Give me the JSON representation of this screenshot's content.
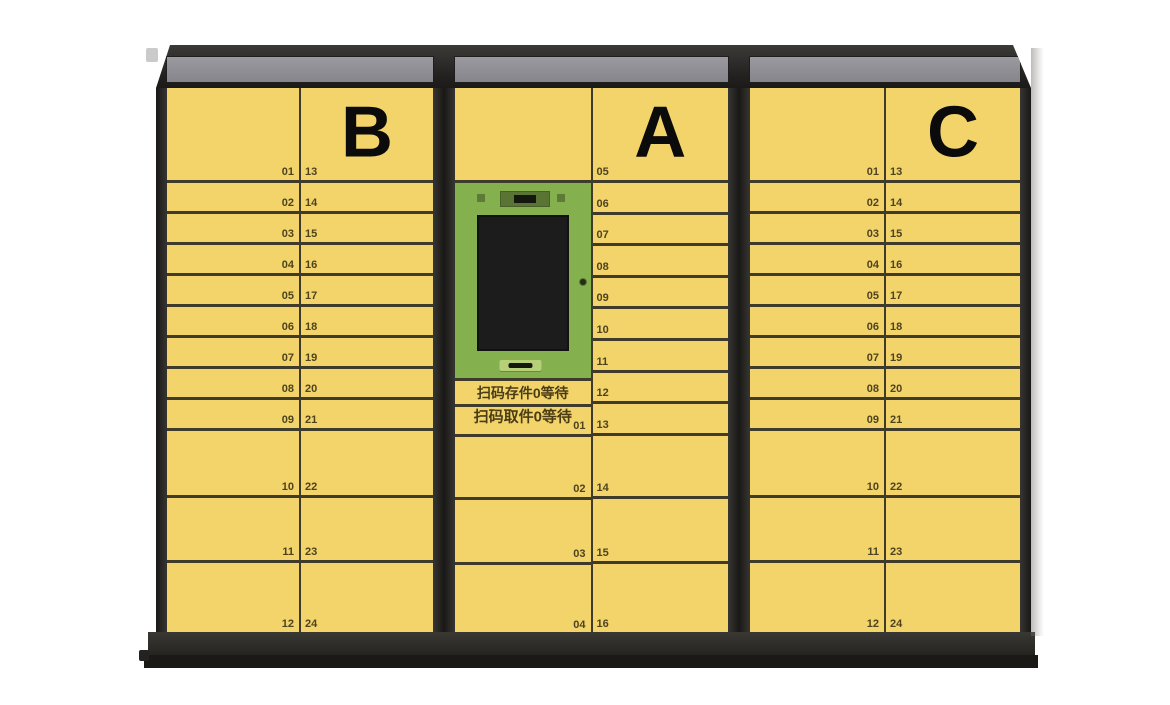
{
  "colors": {
    "door_yellow": "#F2D46A",
    "door_line": "#3E3B2B",
    "frame_dark": "#343330",
    "sign_gray": "#85858B",
    "sign_gray_hi": "#9A9AA0",
    "kiosk_green": "#85B04E",
    "kiosk_dark_green": "#5A7433",
    "kiosk_light_green": "#B6CF79",
    "screen_black": "#1C1C1C",
    "number_text": "#4E431F",
    "cjk_text": "#4A3D16",
    "letter_text": "#0B0B0B",
    "base_dark": "#262420",
    "base_shadow": "#1B1915"
  },
  "cabinets": [
    {
      "id": "b",
      "label": "B",
      "columns": [
        {
          "num_align": "right",
          "cells": [
            {
              "size": "t1",
              "num": "01"
            },
            {
              "size": "s",
              "num": "02"
            },
            {
              "size": "s",
              "num": "03"
            },
            {
              "size": "s",
              "num": "04"
            },
            {
              "size": "s",
              "num": "05"
            },
            {
              "size": "s",
              "num": "06"
            },
            {
              "size": "s",
              "num": "07"
            },
            {
              "size": "s",
              "num": "08"
            },
            {
              "size": "s",
              "num": "09"
            },
            {
              "size": "m1",
              "num": "10"
            },
            {
              "size": "m2",
              "num": "11"
            },
            {
              "size": "m3",
              "num": "12"
            }
          ]
        },
        {
          "num_align": "left",
          "cells": [
            {
              "size": "t1",
              "num": "13",
              "letter": true
            },
            {
              "size": "s",
              "num": "14"
            },
            {
              "size": "s",
              "num": "15"
            },
            {
              "size": "s",
              "num": "16"
            },
            {
              "size": "s",
              "num": "17"
            },
            {
              "size": "s",
              "num": "18"
            },
            {
              "size": "s",
              "num": "19"
            },
            {
              "size": "s",
              "num": "20"
            },
            {
              "size": "s",
              "num": "21"
            },
            {
              "size": "m1",
              "num": "22"
            },
            {
              "size": "m2",
              "num": "23"
            },
            {
              "size": "m3",
              "num": "24"
            }
          ]
        }
      ]
    },
    {
      "id": "a",
      "label": "A",
      "columns": [
        {
          "num_align": "right",
          "cells": [
            {
              "size": "t1"
            },
            {
              "size": "kiosk"
            },
            {
              "size": "tx1",
              "text": "扫码存件0等待"
            },
            {
              "size": "tx2",
              "text": "扫码取件0等待",
              "num": "01"
            },
            {
              "size": "a2",
              "num": "02"
            },
            {
              "size": "a3",
              "num": "03"
            },
            {
              "size": "a4",
              "num": "04"
            }
          ]
        },
        {
          "num_align": "left",
          "cells": [
            {
              "size": "t1",
              "num": "05",
              "letter": true
            },
            {
              "size": "sa",
              "num": "06"
            },
            {
              "size": "sa",
              "num": "07"
            },
            {
              "size": "sa",
              "num": "08"
            },
            {
              "size": "sa",
              "num": "09"
            },
            {
              "size": "sa",
              "num": "10"
            },
            {
              "size": "sa",
              "num": "11"
            },
            {
              "size": "sa",
              "num": "12"
            },
            {
              "size": "sa",
              "num": "13"
            },
            {
              "size": "a2",
              "num": "14"
            },
            {
              "size": "a3",
              "num": "15"
            },
            {
              "size": "a4",
              "num": "16"
            }
          ]
        }
      ]
    },
    {
      "id": "c",
      "label": "C",
      "columns": [
        {
          "num_align": "right",
          "cells": [
            {
              "size": "t1",
              "num": "01"
            },
            {
              "size": "s",
              "num": "02"
            },
            {
              "size": "s",
              "num": "03"
            },
            {
              "size": "s",
              "num": "04"
            },
            {
              "size": "s",
              "num": "05"
            },
            {
              "size": "s",
              "num": "06"
            },
            {
              "size": "s",
              "num": "07"
            },
            {
              "size": "s",
              "num": "08"
            },
            {
              "size": "s",
              "num": "09"
            },
            {
              "size": "m1",
              "num": "10"
            },
            {
              "size": "m2",
              "num": "11"
            },
            {
              "size": "m3",
              "num": "12"
            }
          ]
        },
        {
          "num_align": "left",
          "cells": [
            {
              "size": "t1",
              "num": "13",
              "letter": true
            },
            {
              "size": "s",
              "num": "14"
            },
            {
              "size": "s",
              "num": "15"
            },
            {
              "size": "s",
              "num": "16"
            },
            {
              "size": "s",
              "num": "17"
            },
            {
              "size": "s",
              "num": "18"
            },
            {
              "size": "s",
              "num": "19"
            },
            {
              "size": "s",
              "num": "20"
            },
            {
              "size": "s",
              "num": "21"
            },
            {
              "size": "m1",
              "num": "22"
            },
            {
              "size": "m2",
              "num": "23"
            },
            {
              "size": "m3",
              "num": "24"
            }
          ]
        }
      ]
    }
  ],
  "kiosk_parts": [
    "camera-scanner",
    "led-indicator",
    "kiosk-touch-screen",
    "keyhole-lock",
    "barcode-scan-slot"
  ]
}
